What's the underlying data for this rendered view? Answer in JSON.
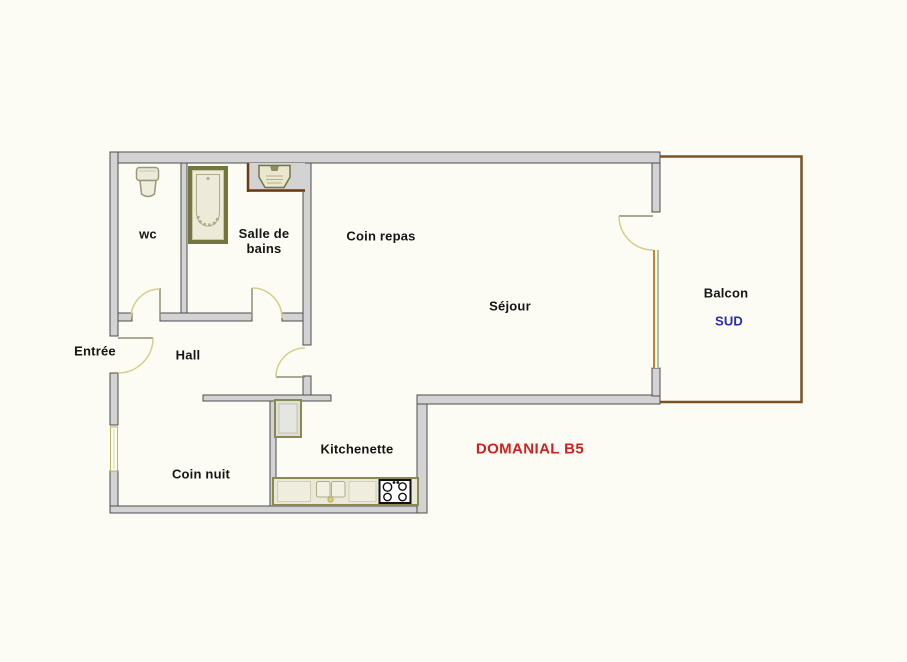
{
  "plan": {
    "labels": {
      "wc": "wc",
      "bathroom_line1": "Salle de",
      "bathroom_line2": "bains",
      "dining": "Coin repas",
      "living": "Séjour",
      "balcony": "Balcon",
      "balcony_orientation": "SUD",
      "entry": "Entrée",
      "hall": "Hall",
      "sleeping": "Coin nuit",
      "kitchen": "Kitchenette",
      "reference": "DOMANIAL B5"
    },
    "colors": {
      "background": "#fcfcf4",
      "wall_fill": "#d3d3d3",
      "wall_outline": "#4d4d4d",
      "balcony_outline": "#7d5222",
      "niche_border": "#6b3a12",
      "fixture_outline": "#74763f",
      "fixture_fill": "#edead9",
      "door_arc": "#d6ce8a",
      "door_leaf": "#8f8f7a",
      "window_orange": "#c8812c",
      "window_green": "#a8c4a8",
      "reference_red": "#cc2222",
      "orientation_blue": "#2a2ab0"
    }
  }
}
